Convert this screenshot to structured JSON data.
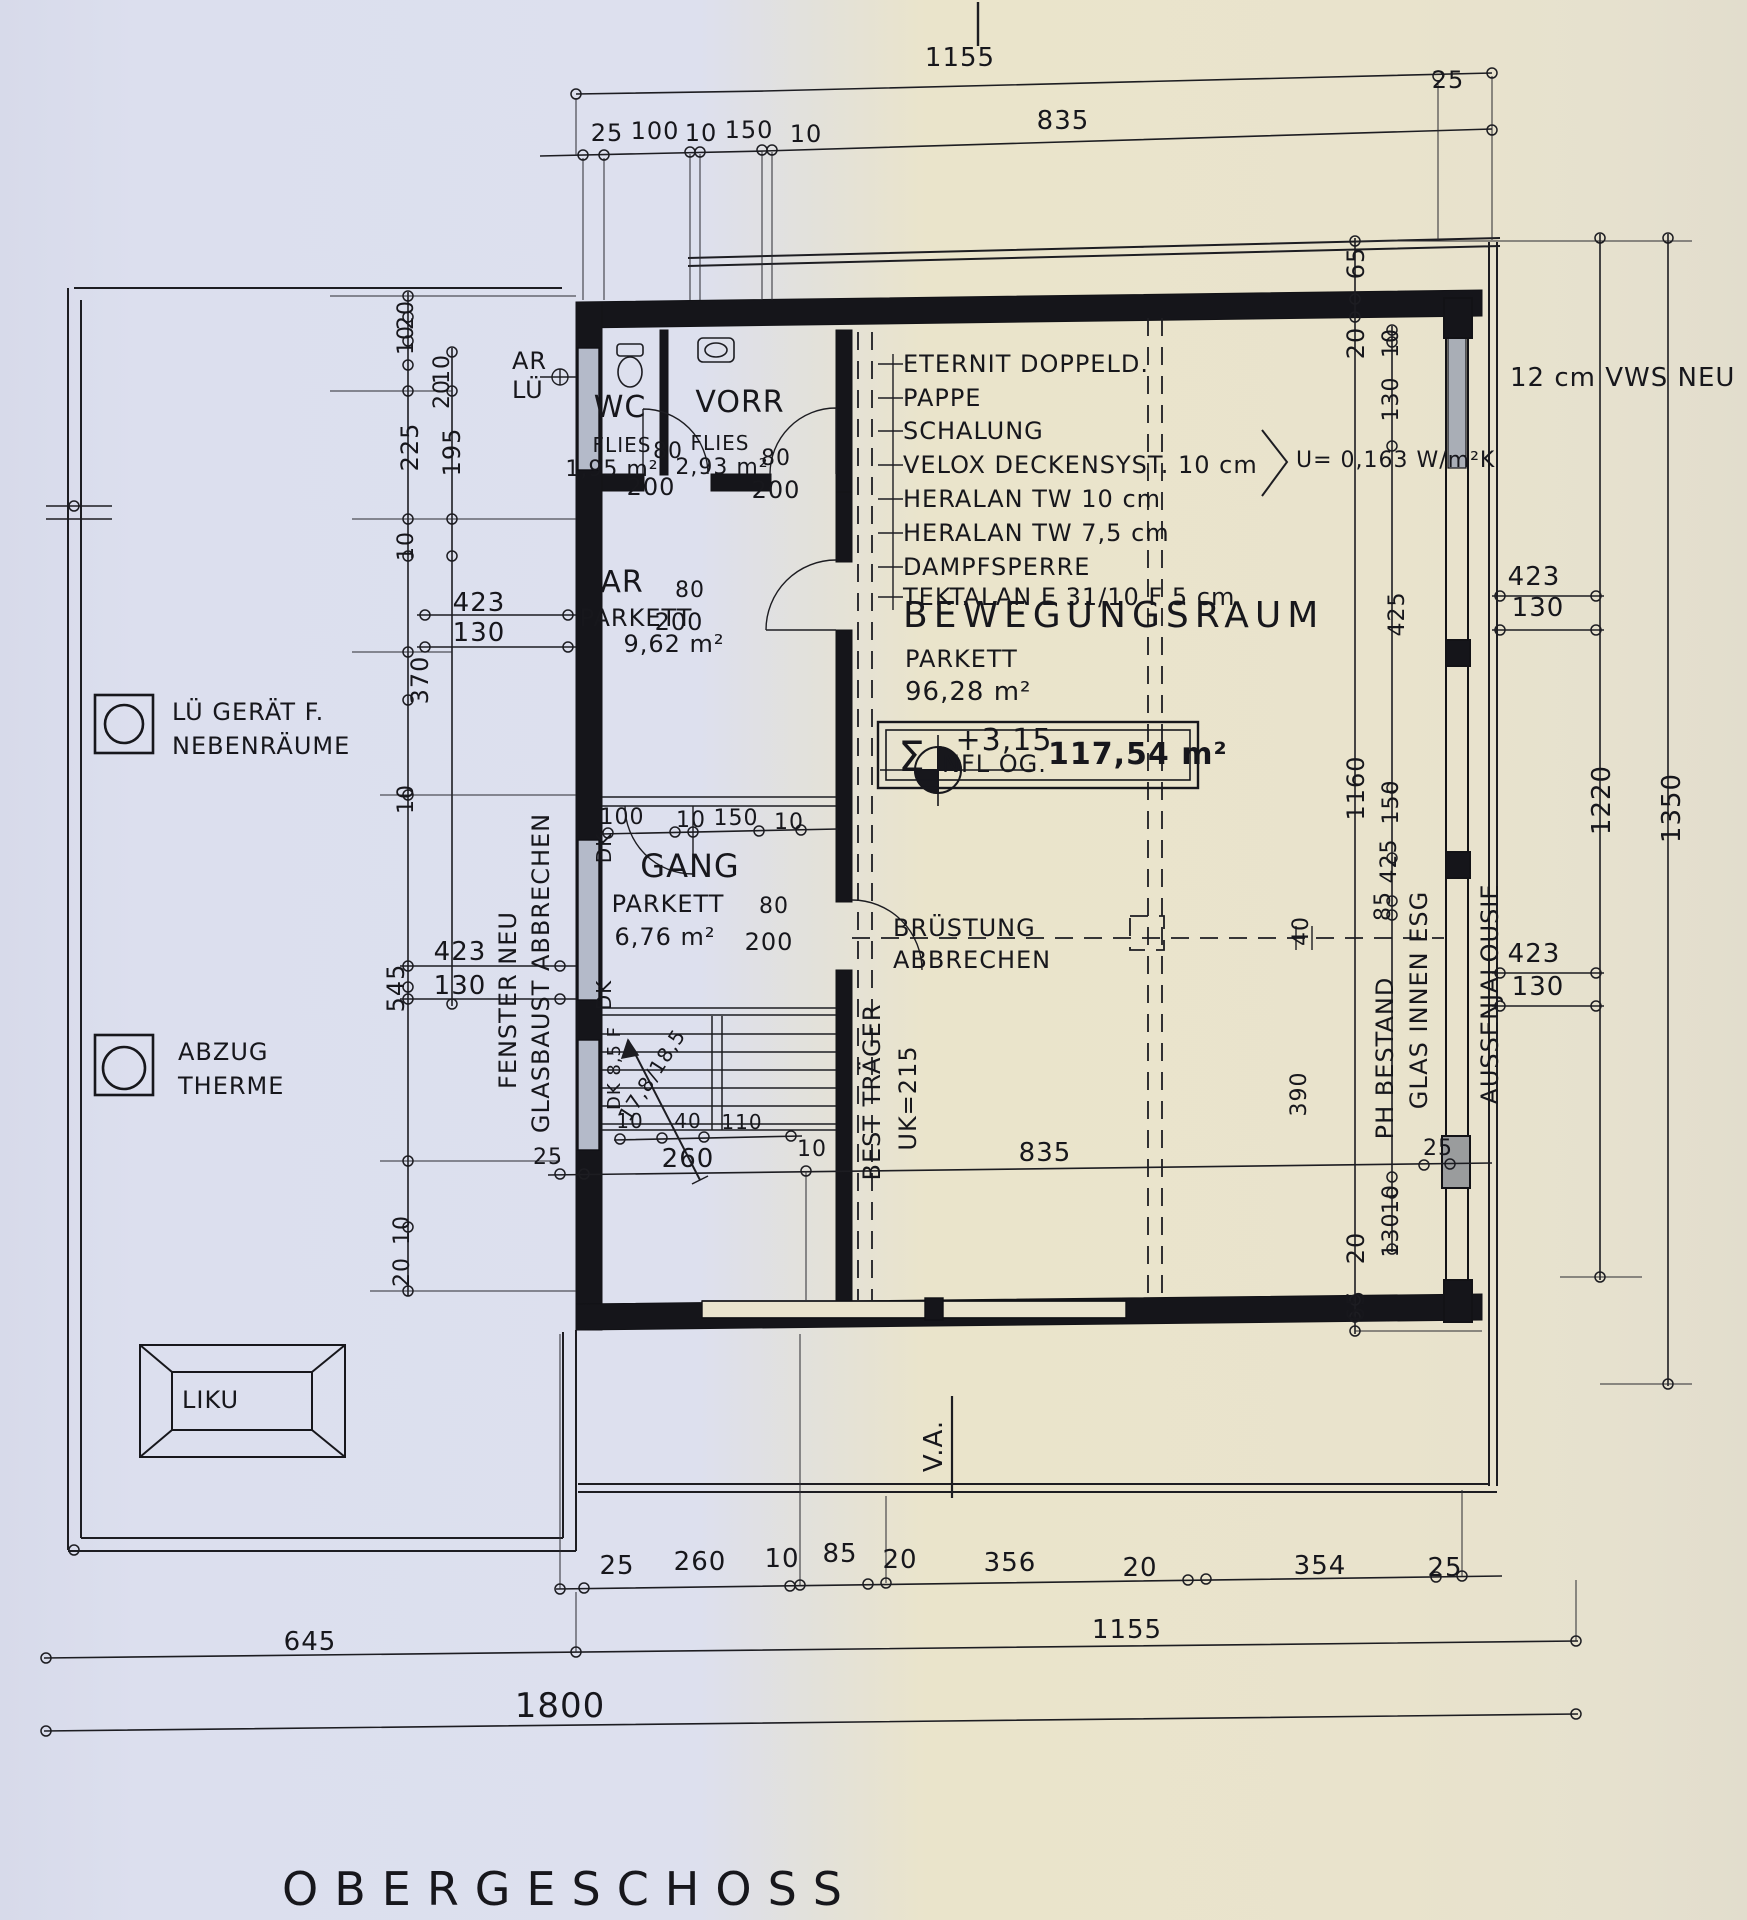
{
  "sheet": {
    "title": "OBERGESCHOSS"
  },
  "legend": {
    "lue_line1": "LÜ GERÄT F.",
    "lue_line2": "NEBENRÄUME",
    "abzug_line1": "ABZUG",
    "abzug_line2": "THERME",
    "liku": "LIKU"
  },
  "rooms": {
    "wc": {
      "name": "WC",
      "floor": "FLIES",
      "area": "1,95 m²",
      "door_w": "80",
      "door_h": "200"
    },
    "vorr": {
      "name": "VORR",
      "floor": "FLIES",
      "area": "2,93 m²",
      "door_w": "80",
      "door_h": "200"
    },
    "ar": {
      "name": "AR",
      "floor": "PARKETT",
      "area": "9,62 m²",
      "door_w": "80",
      "door_h": "200"
    },
    "gang": {
      "name": "GANG",
      "floor": "PARKETT",
      "area": "6,76 m²",
      "door_w": "80",
      "door_h": "200"
    },
    "bewegungsraum": {
      "name": "BEWEGUNGSRAUM",
      "floor": "PARKETT",
      "area": "96,28 m²",
      "level": "+3,15"
    }
  },
  "ceiling_buildup": [
    "ETERNIT DOPPELD.",
    "PAPPE",
    "SCHALUNG",
    "VELOX DECKENSYST. 10 cm",
    "HERALAN TW 10 cm",
    "HERALAN TW 7,5 cm",
    "DAMPFSPERRE",
    "TEKTALAN E 31/10 F 5 cm"
  ],
  "u_value": "U= 0,163 W/m²K",
  "sum_area": {
    "sigma": "Σ",
    "label": "NFL OG.",
    "value": "117,54 m²"
  },
  "annotations": {
    "ar_lue_1": "AR",
    "ar_lue_2": "LÜ",
    "vws": "12 cm VWS NEU",
    "bruestung_1": "BRÜSTUNG",
    "bruestung_2": "ABBRECHEN",
    "best_traeger": "BEST TRÄGER",
    "best_traeger_uk": "UK=215",
    "fenster_neu": "FENSTER NEU",
    "glasbaust": "GLASBAUST ABBRECHEN",
    "ph_bestand": "PH BESTAND",
    "glas_innen": "GLAS INNEN ESG",
    "jalousie": "AUSSENJALOUSIE",
    "dk": "DK",
    "stair_note": "17,8/18,5",
    "stair_dk": "DK 8,5 F",
    "va": "V.A."
  },
  "dims": {
    "top_total": "1155",
    "top_right_offset": "25",
    "top_sub": [
      "25",
      "100",
      "10",
      "150",
      "10"
    ],
    "top_sub_total": "835",
    "left_col": [
      "20",
      "10",
      "10",
      "20",
      "225",
      "195",
      "10",
      "370",
      "10",
      "545",
      "10",
      "20"
    ],
    "left_pair_upper": {
      "w": "423",
      "h": "130"
    },
    "left_pair_lower": {
      "w": "423",
      "h": "130"
    },
    "right_col_inner": [
      "65",
      "20",
      "1160",
      "20",
      "65"
    ],
    "right_col_mid": [
      "10",
      "130",
      "425",
      "150",
      "425",
      "85",
      "40",
      "390",
      "10",
      "130"
    ],
    "right_pair_upper": {
      "w": "423",
      "h": "130"
    },
    "right_pair_lower": {
      "w": "423",
      "h": "130"
    },
    "right_total_inner": "1220",
    "right_total_outer": "1350",
    "gang_row": [
      "100",
      "10",
      "150",
      "10"
    ],
    "stair_row": [
      "10",
      "40",
      "110"
    ],
    "interior_bottom": [
      "25",
      "260",
      "10",
      "835",
      "25"
    ],
    "bottom_row1": [
      "25",
      "260",
      "10",
      "85",
      "20",
      "356",
      "20",
      "354",
      "25"
    ],
    "bottom_row2": [
      "645",
      "1155"
    ],
    "bottom_total": "1800"
  }
}
